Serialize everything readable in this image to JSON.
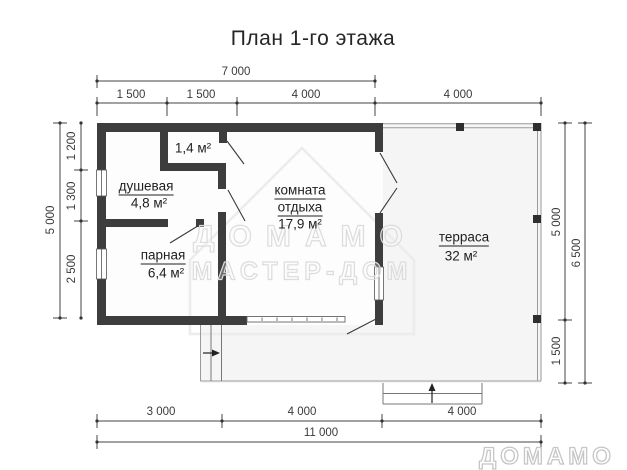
{
  "title": "План 1-го этажа",
  "rooms": {
    "closet": {
      "area": "1,4 м²"
    },
    "shower": {
      "name": "душевая",
      "area": "4,8 м²"
    },
    "steam": {
      "name": "парная",
      "area": "6,4 м²"
    },
    "lounge": {
      "name_line1": "комната",
      "name_line2": "отдыха",
      "area": "17,9 м²"
    },
    "terrace": {
      "name": "терраса",
      "area": "32 м²"
    }
  },
  "dims": {
    "top_total": "7 000",
    "top_1": "1 500",
    "top_2": "1 500",
    "top_3": "4 000",
    "top_4": "4 000",
    "bottom_1": "3 000",
    "bottom_2": "4 000",
    "bottom_3": "4 000",
    "bottom_total": "11 000",
    "left_total": "5 000",
    "left_1": "1 200",
    "left_2": "1 300",
    "left_3": "2 500",
    "right_1": "5 000",
    "right_2": "1 500",
    "right_total": "6 500"
  },
  "watermark": {
    "line1": "ДОМАМО",
    "line2": "МАСТЕР-ДОМ",
    "logo": "ДОМАМО"
  },
  "colors": {
    "wall": "#3d3d3d",
    "terrace_fill": "#f5f5f5",
    "dim_line": "#444444",
    "watermark": "#dcdcdc"
  }
}
